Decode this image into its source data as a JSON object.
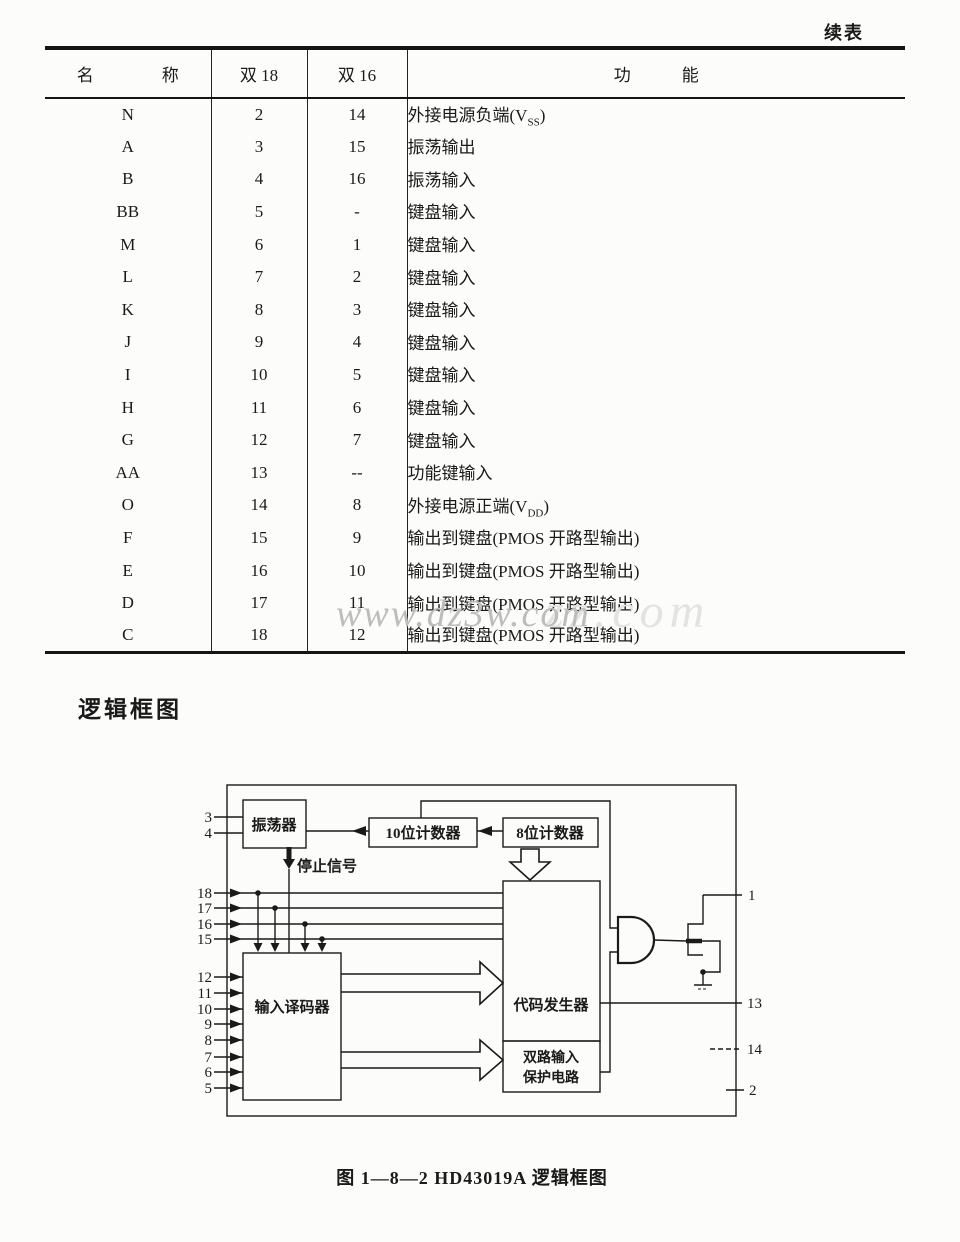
{
  "page": {
    "continued_label": "续表",
    "section_title": "逻辑框图",
    "caption": "图 1—8—2   HD43019A 逻辑框图",
    "watermark": "www.dz3w.com",
    "watermark_ghost": "zz.com"
  },
  "table": {
    "headers": {
      "name": "名　　　　称",
      "dual18": "双 18",
      "dual16": "双 16",
      "func": "功　　　能"
    },
    "rows": [
      {
        "name": "N",
        "d18": "2",
        "d16": "14",
        "f1": "外接电源负端(V",
        "f2": "SS",
        "f3": ")"
      },
      {
        "name": "A",
        "d18": "3",
        "d16": "15",
        "f1": "振荡输出",
        "f2": "",
        "f3": ""
      },
      {
        "name": "B",
        "d18": "4",
        "d16": "16",
        "f1": "振荡输入",
        "f2": "",
        "f3": ""
      },
      {
        "name": "BB",
        "d18": "5",
        "d16": "-",
        "f1": "键盘输入",
        "f2": "",
        "f3": ""
      },
      {
        "name": "M",
        "d18": "6",
        "d16": "1",
        "f1": "键盘输入",
        "f2": "",
        "f3": ""
      },
      {
        "name": "L",
        "d18": "7",
        "d16": "2",
        "f1": "键盘输入",
        "f2": "",
        "f3": ""
      },
      {
        "name": "K",
        "d18": "8",
        "d16": "3",
        "f1": "键盘输入",
        "f2": "",
        "f3": ""
      },
      {
        "name": "J",
        "d18": "9",
        "d16": "4",
        "f1": "键盘输入",
        "f2": "",
        "f3": ""
      },
      {
        "name": "I",
        "d18": "10",
        "d16": "5",
        "f1": "键盘输入",
        "f2": "",
        "f3": ""
      },
      {
        "name": "H",
        "d18": "11",
        "d16": "6",
        "f1": "键盘输入",
        "f2": "",
        "f3": ""
      },
      {
        "name": "G",
        "d18": "12",
        "d16": "7",
        "f1": "键盘输入",
        "f2": "",
        "f3": ""
      },
      {
        "name": "AA",
        "d18": "13",
        "d16": "--",
        "f1": "功能键输入",
        "f2": "",
        "f3": ""
      },
      {
        "name": "O",
        "d18": "14",
        "d16": "8",
        "f1": "外接电源正端(V",
        "f2": "DD",
        "f3": ")"
      },
      {
        "name": "F",
        "d18": "15",
        "d16": "9",
        "f1": "输出到键盘(PMOS 开路型输出)",
        "f2": "",
        "f3": ""
      },
      {
        "name": "E",
        "d18": "16",
        "d16": "10",
        "f1": "输出到键盘(PMOS 开路型输出)",
        "f2": "",
        "f3": ""
      },
      {
        "name": "D",
        "d18": "17",
        "d16": "11",
        "f1": "输出到键盘(PMOS 开路型输出)",
        "f2": "",
        "f3": ""
      },
      {
        "name": "C",
        "d18": "18",
        "d16": "12",
        "f1": "输出到键盘(PMOS 开路型输出)",
        "f2": "",
        "f3": ""
      }
    ]
  },
  "diagram": {
    "oscillator": "振荡器",
    "counter10": "10位计数器",
    "counter8": "8位计数器",
    "stop_signal": "停止信号",
    "decoder": "输入译码器",
    "code_generator": "代码发生器",
    "protection1": "双路输入",
    "protection2": "保护电路",
    "pins": {
      "osc": [
        "3",
        "4"
      ],
      "groupA": [
        "18",
        "17",
        "16",
        "15"
      ],
      "groupB": [
        "12",
        "11",
        "10",
        "9",
        "8",
        "7",
        "6",
        "5"
      ],
      "right": [
        "1",
        "13",
        "14",
        "2"
      ]
    }
  }
}
